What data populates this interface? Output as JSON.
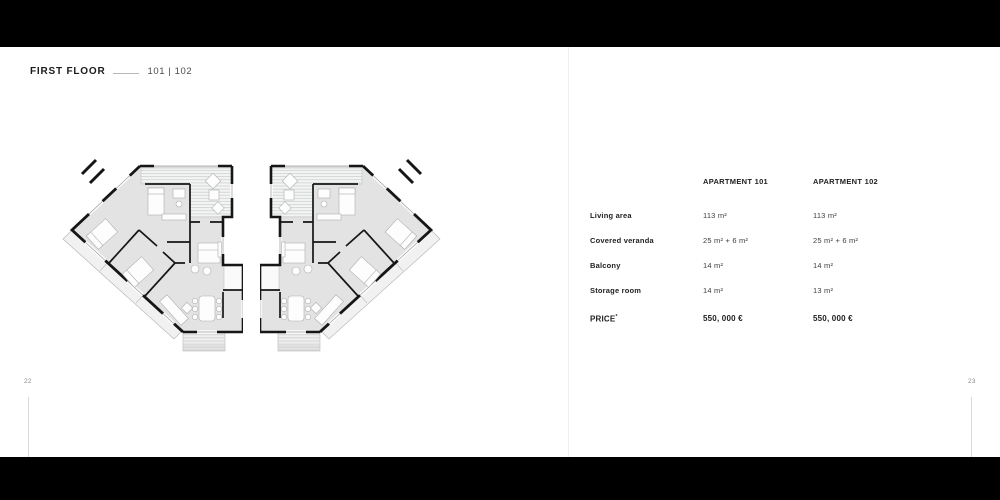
{
  "header": {
    "title": "FIRST FLOOR",
    "units": "101 | 102"
  },
  "spec_table": {
    "col_headers": [
      "APARTMENT 101",
      "APARTMENT 102"
    ],
    "rows": [
      {
        "label": "Living area",
        "values": [
          "113 m²",
          "113 m²"
        ]
      },
      {
        "label": "Covered veranda",
        "values": [
          "25 m² + 6 m²",
          "25 m² + 6 m²"
        ]
      },
      {
        "label": "Balcony",
        "values": [
          "14 m²",
          "14 m²"
        ]
      },
      {
        "label": "Storage room",
        "values": [
          "14 m²",
          "13 m²"
        ]
      }
    ],
    "price": {
      "label": "PRICE",
      "sup": "*",
      "values": [
        "550, 000 €",
        "550, 000 €"
      ]
    }
  },
  "footer": {
    "left_page": "22",
    "right_page": "23"
  },
  "colors": {
    "top_bottom_bars": "#000000",
    "plan_wall": "#161616",
    "plan_room_fill": "#e3e3e3",
    "deck_hatch_line": "#c7cbca"
  }
}
